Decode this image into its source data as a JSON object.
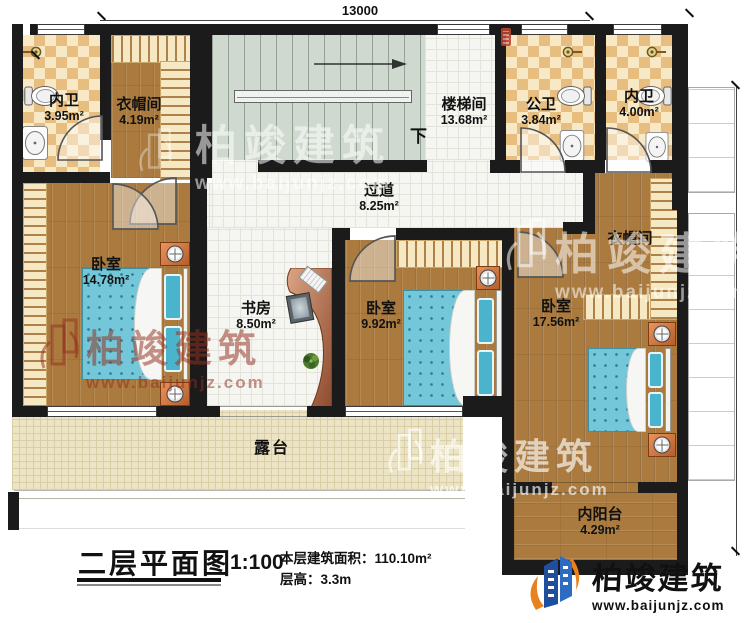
{
  "dimensions": {
    "top": "13000",
    "right": "10300"
  },
  "rooms": [
    {
      "name": "内卫",
      "area": "3.95m²"
    },
    {
      "name": "衣帽间",
      "area": "4.19m²"
    },
    {
      "name": "楼梯间",
      "area": "13.68m²"
    },
    {
      "name": "公卫",
      "area": "3.84m²"
    },
    {
      "name": "内卫",
      "area": "4.00m²"
    },
    {
      "name": "过道",
      "area": "8.25m²"
    },
    {
      "name": "卧室",
      "area": "14.78m²"
    },
    {
      "name": "书房",
      "area": "8.50m²"
    },
    {
      "name": "卧室",
      "area": "9.92m²"
    },
    {
      "name": "卧室",
      "area": "17.56m²"
    },
    {
      "name": "衣帽间",
      "area": ""
    },
    {
      "name": "露台",
      "area": ""
    },
    {
      "name": "内阳台",
      "area": "4.29m²"
    }
  ],
  "stairs": {
    "down_label": "下"
  },
  "title_block": {
    "title": "二层平面图",
    "scale": "1:100",
    "area_label": "本层建筑面积：110.10m²",
    "height_label": "层高：3.3m"
  },
  "watermark": {
    "brand": "柏竣建筑",
    "url": "www.baijunjz.com"
  },
  "logo": {
    "brand": "柏竣建筑",
    "url": "www.baijunjz.com"
  },
  "colors": {
    "wall": "#1b1b1b",
    "wood_floor": "#aa7a3e",
    "tile_light": "#f7e9c6",
    "tile_dark": "#e7bd80",
    "white_floor": "#f5f5f1",
    "stairs_floor": "#cfd9cf",
    "terrace_floor": "#ece4c4",
    "bed_blue": "#74c7d8",
    "nightstand_orange": "#b55d2b",
    "logo_blue": "#1d4f9e",
    "logo_orange": "#e8821e"
  }
}
